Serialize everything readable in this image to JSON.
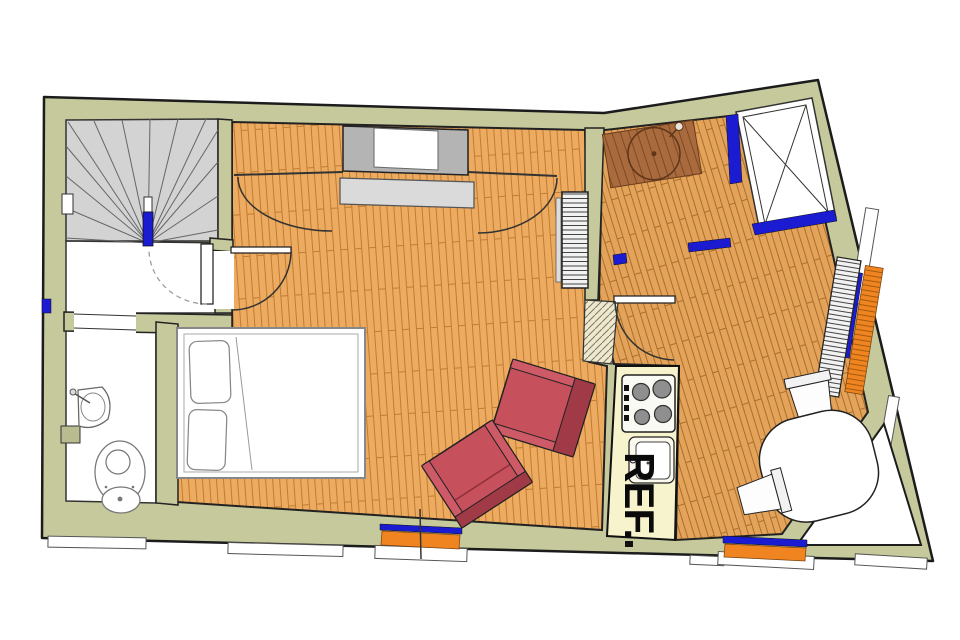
{
  "labels": {
    "refrigerator": "REF."
  },
  "colors": {
    "wall": "#c6c99c",
    "outline": "#1c1c1c",
    "floor_living": "#ecab60",
    "floor_living_plank": "#c07c31",
    "floor_kitchen": "#e3a35a",
    "floor_kitchen_plank": "#aa6f2b",
    "mat_brown": "#a96a3e",
    "stair_gray": "#d3d3d3",
    "closet_gray": "#b4b4b4",
    "dresser_gray": "#dadada",
    "accent_blue": "#1b1bd1",
    "radiator_orange": "#ef8420",
    "chair_red": "#c6505c",
    "chair_red_dark": "#a03a47",
    "counter_cream": "#f7f3cd",
    "fixture_white": "#ffffff"
  }
}
